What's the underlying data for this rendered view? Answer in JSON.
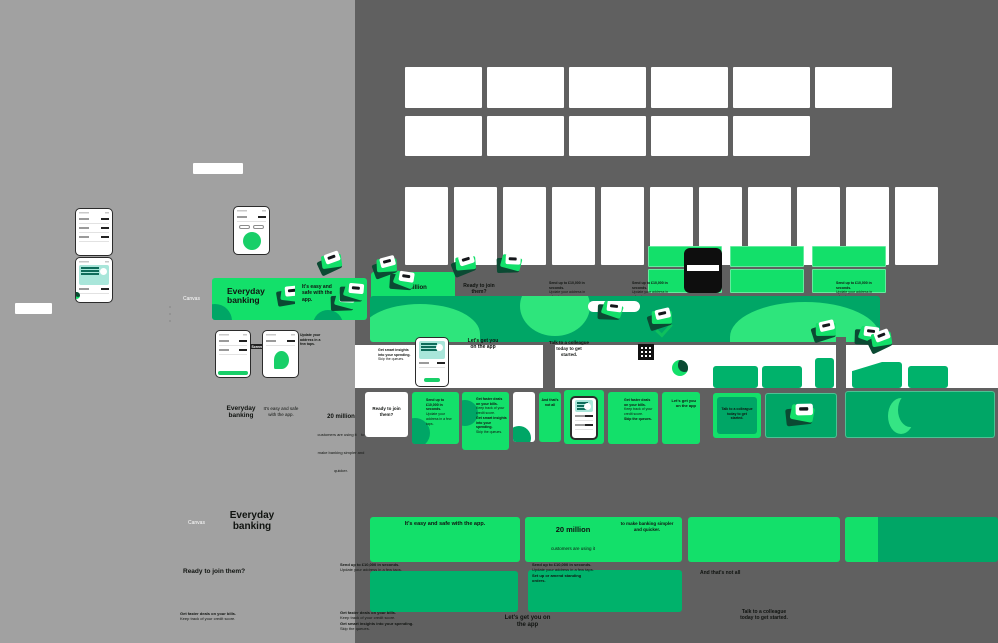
{
  "colors": {
    "bright_green": "#13E06A",
    "teal_green": "#00A666",
    "deep_green": "#0B4A33",
    "canvas_left_bg": "#A1A1A1",
    "canvas_right_bg": "#606060"
  },
  "labels": {
    "canvas_section_1": "Canvas",
    "canvas_section_2": "Canvas",
    "flow_label": "Screen"
  },
  "headlines": {
    "everyday": "Everyday banking",
    "easy": "It's easy and safe with the app.",
    "millions": "20 million",
    "millions_sub": "customers are using it",
    "millions_tail": "to make banking simpler and quicker.",
    "ready": "Ready to join them?",
    "lets": "Let's get you on the app",
    "talk": "Talk to a colleague today to get started.",
    "thats": "And that's not all"
  },
  "bullets": {
    "send": "Send up to £10,000 in seconds.",
    "update": "Update your address in a few taps.",
    "deals": "Get faster deals on your bills.",
    "credit": "Keep track of your credit score.",
    "insights": "Get smart insights into your spending.",
    "queues": "Skip the queues.",
    "amend": "Set up or amend standing orders."
  }
}
